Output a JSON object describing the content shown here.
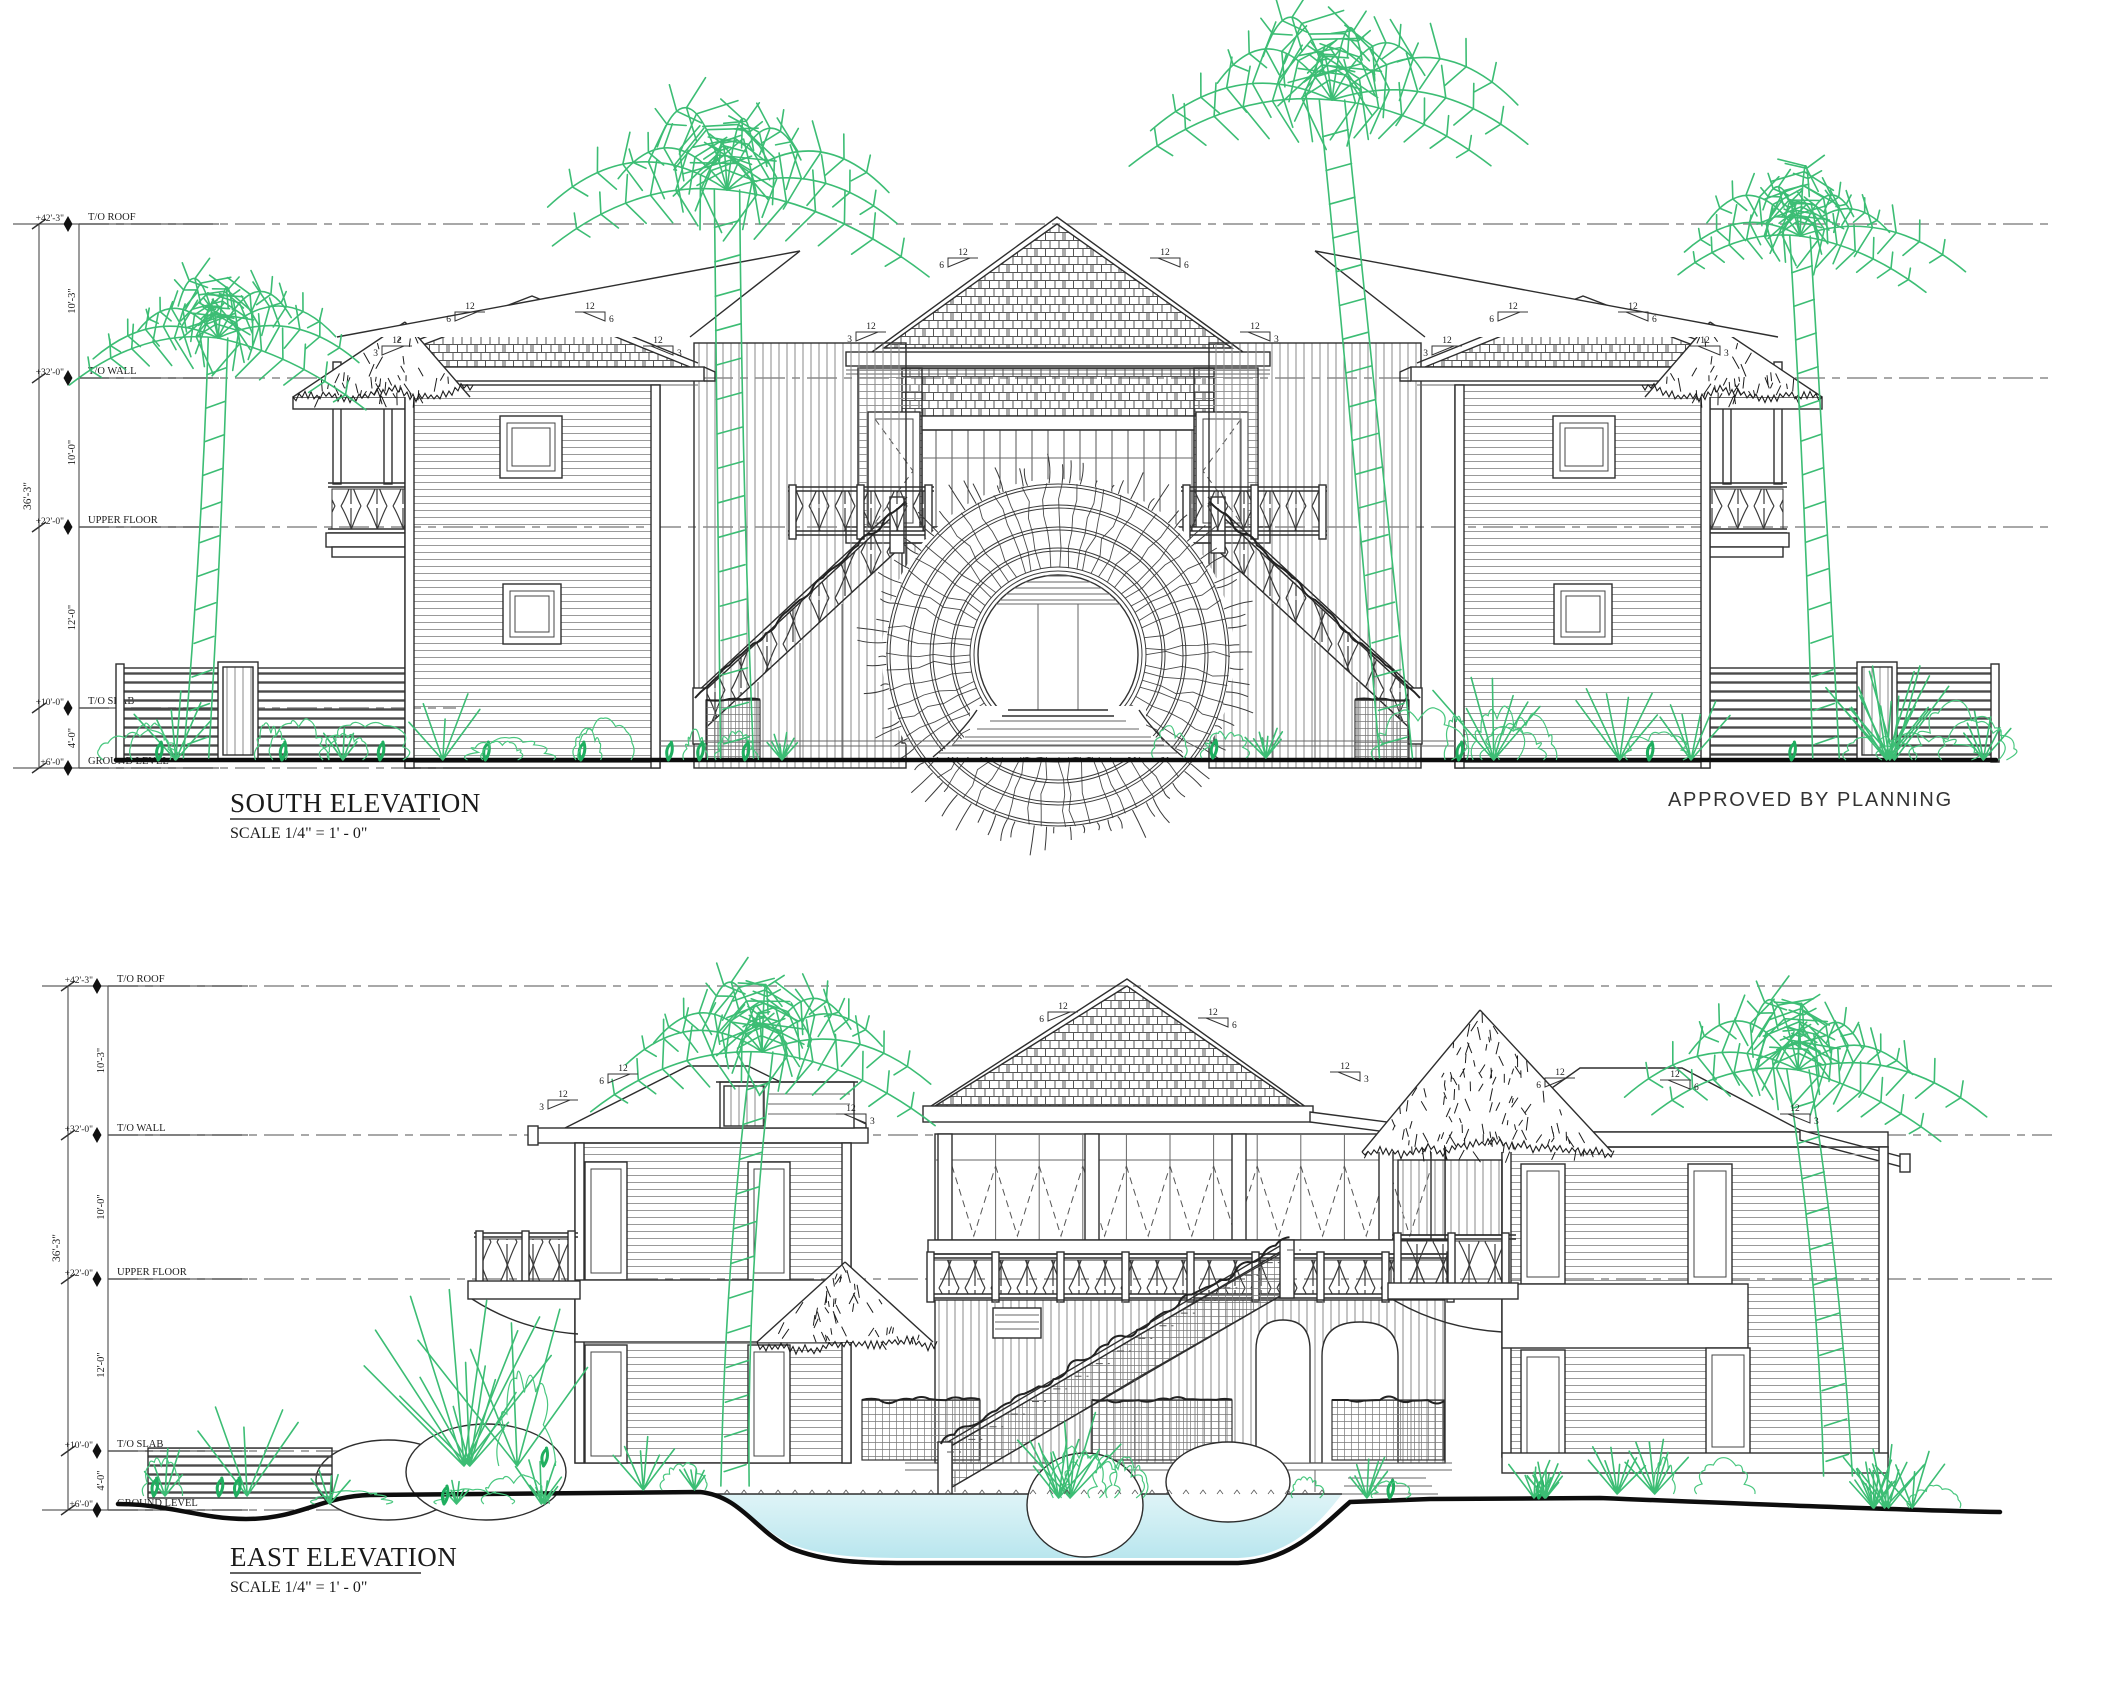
{
  "sheet": {
    "background": "#ffffff",
    "stamp": "APPROVED BY PLANNING",
    "ink": "#2b2b2b",
    "vegetation_green": "#3cbd74",
    "pool_blue": "#b9e6ee"
  },
  "levels": [
    {
      "id": "roof",
      "label": "T/O ROOF",
      "value": "+42'-3\""
    },
    {
      "id": "wall",
      "label": "T/O WALL",
      "value": "+32'-0\""
    },
    {
      "id": "upper",
      "label": "UPPER FLOOR",
      "value": "+22'-0\""
    },
    {
      "id": "slab",
      "label": "T/O SLAB",
      "value": "+10'-0\""
    },
    {
      "id": "ground",
      "label": "GROUND LEVEL",
      "value": "+6'-0\""
    }
  ],
  "dimensions": {
    "roof_to_wall": "10'-3\"",
    "wall_to_upper": "10'-0\"",
    "upper_to_slab": "12'-0\"",
    "slab_to_ground": "4'-0\"",
    "overall": "36'-3\""
  },
  "slope": {
    "rise": "12",
    "run_main": "6",
    "run_eave": "3"
  },
  "views": {
    "south": {
      "title": "SOUTH ELEVATION",
      "scale": "SCALE 1/4\" = 1' - 0\""
    },
    "east": {
      "title": "EAST ELEVATION",
      "scale": "SCALE 1/4\" = 1' - 0\""
    }
  }
}
